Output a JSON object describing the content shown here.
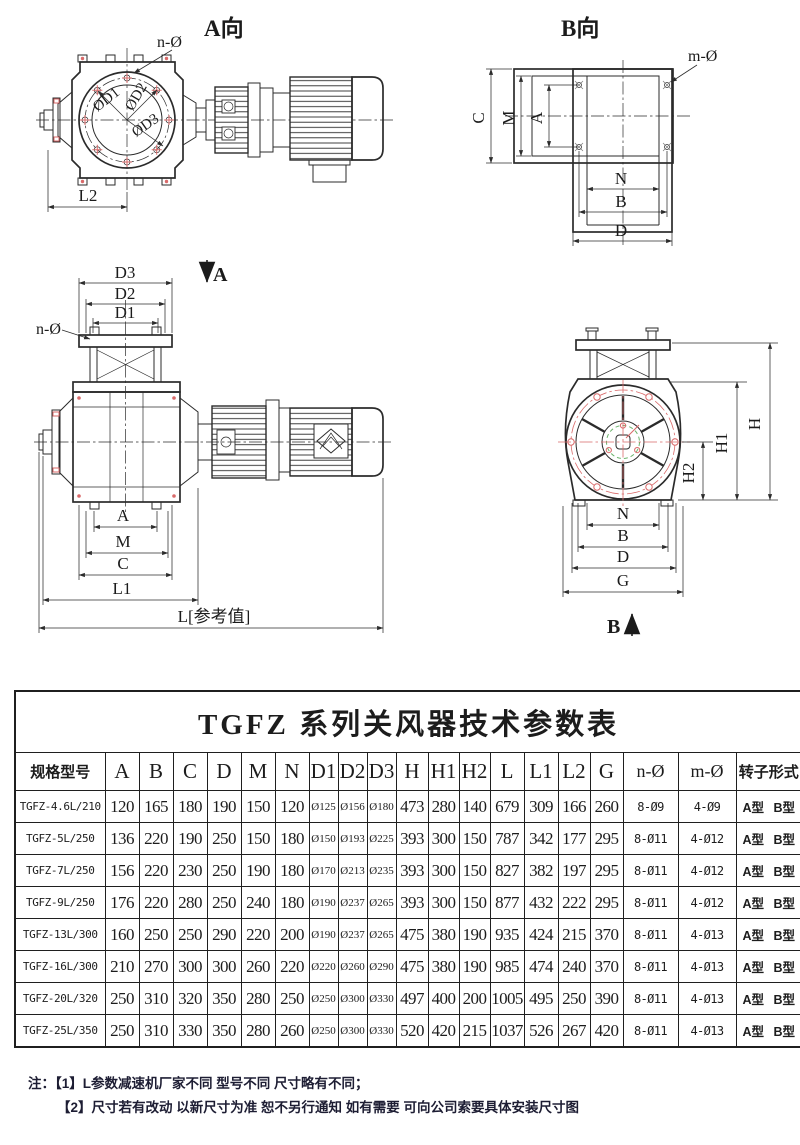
{
  "colors": {
    "line": "#2b2b2b",
    "red_accent": "#d96a6a",
    "green_accent": "#6db36d"
  },
  "views": {
    "view_a": {
      "title": "A向",
      "n_hole": "n-Ø",
      "d1": "ØD1",
      "d2": "ØD2",
      "d3": "ØD3",
      "l2": "L2"
    },
    "view_b": {
      "title": "B向",
      "m_hole": "m-Ø",
      "c": "C",
      "m": "M",
      "a": "A",
      "n": "N",
      "b": "B",
      "d": "D"
    },
    "front": {
      "section_mark": "A",
      "d3": "D3",
      "d2": "D2",
      "d1": "D1",
      "n_hole": "n-Ø",
      "a": "A",
      "m": "M",
      "c": "C",
      "l1": "L1",
      "l_ref": "L[参考值]"
    },
    "side": {
      "h": "H",
      "h1": "H1",
      "h2": "H2",
      "n": "N",
      "b": "B",
      "d": "D",
      "g": "G",
      "section_mark": "B"
    }
  },
  "table": {
    "title": "TGFZ 系列关风器技术参数表",
    "headers": [
      "规格型号",
      "A",
      "B",
      "C",
      "D",
      "M",
      "N",
      "D1",
      "D2",
      "D3",
      "H",
      "H1",
      "H2",
      "L",
      "L1",
      "L2",
      "G",
      "n-Ø",
      "m-Ø",
      "转子形式"
    ],
    "rows": [
      [
        "TGFZ-4.6L/210",
        "120",
        "165",
        "180",
        "190",
        "150",
        "120",
        "Ø125",
        "Ø156",
        "Ø180",
        "473",
        "280",
        "140",
        "679",
        "309",
        "166",
        "260",
        "8-Ø9",
        "4-Ø9",
        "A型 B型"
      ],
      [
        "TGFZ-5L/250",
        "136",
        "220",
        "190",
        "250",
        "150",
        "180",
        "Ø150",
        "Ø193",
        "Ø225",
        "393",
        "300",
        "150",
        "787",
        "342",
        "177",
        "295",
        "8-Ø11",
        "4-Ø12",
        "A型 B型"
      ],
      [
        "TGFZ-7L/250",
        "156",
        "220",
        "230",
        "250",
        "190",
        "180",
        "Ø170",
        "Ø213",
        "Ø235",
        "393",
        "300",
        "150",
        "827",
        "382",
        "197",
        "295",
        "8-Ø11",
        "4-Ø12",
        "A型 B型"
      ],
      [
        "TGFZ-9L/250",
        "176",
        "220",
        "280",
        "250",
        "240",
        "180",
        "Ø190",
        "Ø237",
        "Ø265",
        "393",
        "300",
        "150",
        "877",
        "432",
        "222",
        "295",
        "8-Ø11",
        "4-Ø12",
        "A型 B型"
      ],
      [
        "TGFZ-13L/300",
        "160",
        "250",
        "250",
        "290",
        "220",
        "200",
        "Ø190",
        "Ø237",
        "Ø265",
        "475",
        "380",
        "190",
        "935",
        "424",
        "215",
        "370",
        "8-Ø11",
        "4-Ø13",
        "A型 B型"
      ],
      [
        "TGFZ-16L/300",
        "210",
        "270",
        "300",
        "300",
        "260",
        "220",
        "Ø220",
        "Ø260",
        "Ø290",
        "475",
        "380",
        "190",
        "985",
        "474",
        "240",
        "370",
        "8-Ø11",
        "4-Ø13",
        "A型 B型"
      ],
      [
        "TGFZ-20L/320",
        "250",
        "310",
        "320",
        "350",
        "280",
        "250",
        "Ø250",
        "Ø300",
        "Ø330",
        "497",
        "400",
        "200",
        "1005",
        "495",
        "250",
        "390",
        "8-Ø11",
        "4-Ø13",
        "A型 B型"
      ],
      [
        "TGFZ-25L/350",
        "250",
        "310",
        "330",
        "350",
        "280",
        "260",
        "Ø250",
        "Ø300",
        "Ø330",
        "520",
        "420",
        "215",
        "1037",
        "526",
        "267",
        "420",
        "8-Ø11",
        "4-Ø13",
        "A型 B型"
      ]
    ]
  },
  "notes": {
    "prefix": "注：",
    "items": [
      "【1】L参数减速机厂家不同 型号不同 尺寸略有不同；",
      "【2】尺寸若有改动 以新尺寸为准 恕不另行通知 如有需要 可向公司索要具体安装尺寸图"
    ]
  }
}
